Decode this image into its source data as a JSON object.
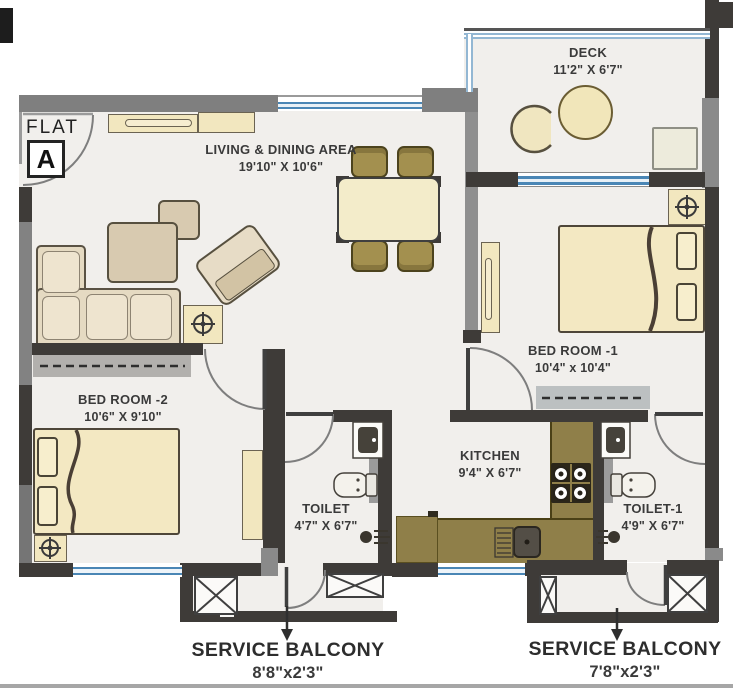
{
  "flat": {
    "label": "FLAT",
    "unit": "A"
  },
  "rooms": {
    "living": {
      "name": "LIVING & DINING AREA",
      "dims": "19'10\" X 10'6\""
    },
    "deck": {
      "name": "DECK",
      "dims": "11'2\" X 6'7\""
    },
    "bedroom1": {
      "name": "BED ROOM -1",
      "dims": "10'4\" x 10'4\""
    },
    "bedroom2": {
      "name": "BED ROOM -2",
      "dims": "10'6\" X 9'10\""
    },
    "kitchen": {
      "name": "KITCHEN",
      "dims": "9'4\" X 6'7\""
    },
    "toilet": {
      "name": "TOILET",
      "dims": "4'7\" X 6'7\""
    },
    "toilet1": {
      "name": "TOILET-1",
      "dims": "4'9\" X 6'7\""
    },
    "balcony_left": {
      "name": "SERVICE BALCONY",
      "dims": "8'8\"x2'3\""
    },
    "balcony_right": {
      "name": "SERVICE BALCONY",
      "dims": "7'8\"x2'3\""
    }
  },
  "colors": {
    "wall_dark": "#3e3b38",
    "wall_gray": "#828282",
    "floor": "#f1efec",
    "window_blue": "#4a86b5",
    "furniture_cream": "#f3e8c2",
    "chair_olive": "#a3904f",
    "counter_olive": "#8f7f49",
    "text": "#3a3a3a"
  }
}
